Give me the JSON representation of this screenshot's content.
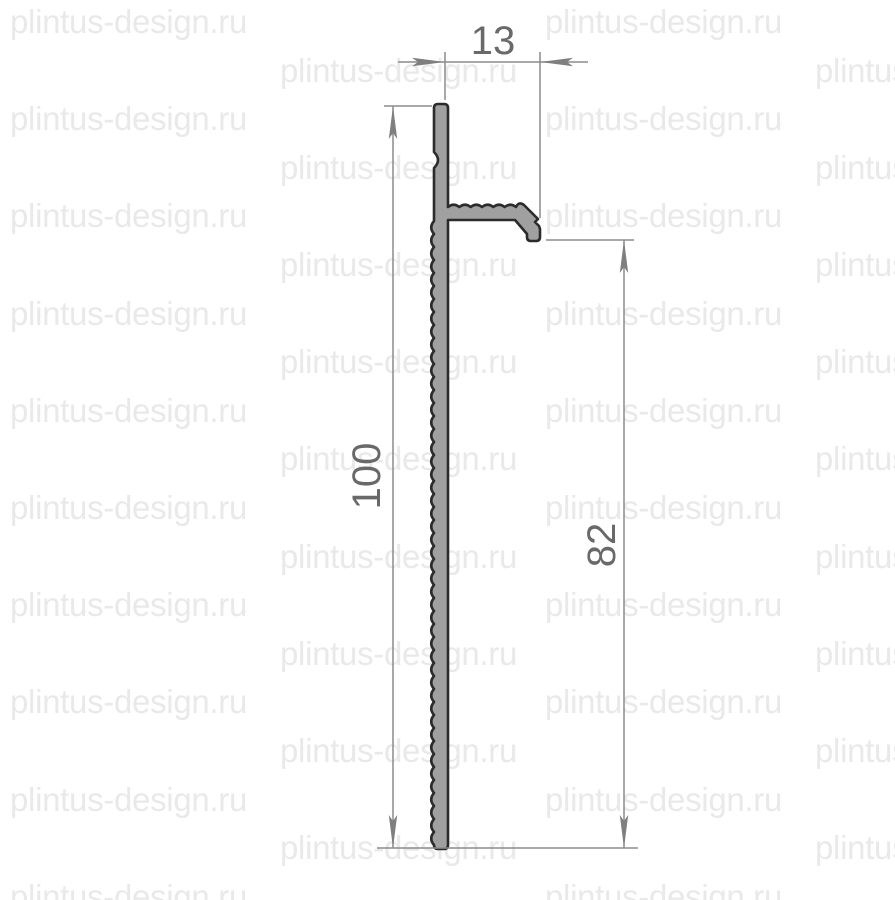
{
  "page": {
    "background_color": "#ffffff"
  },
  "watermark": {
    "text": "plintus-design.ru",
    "color": "#e9e9e9"
  },
  "drawing": {
    "name": "aluminum-skirting-profile-cross-section",
    "profile_fill_color": "#a0a0a0",
    "profile_outline_color": "#2b2b2b",
    "dimension_line_color": "#8c8c8c",
    "dimension_text_color": "#696969",
    "dimensions": {
      "top_width": "13",
      "left_height": "100",
      "right_height": "82"
    }
  }
}
